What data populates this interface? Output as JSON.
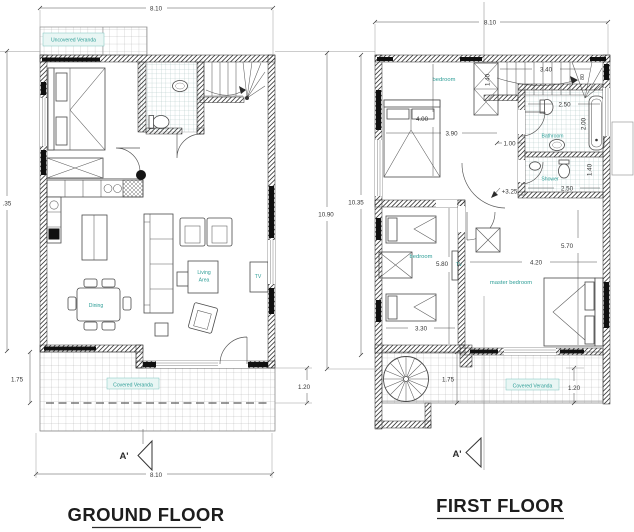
{
  "meta": {
    "teal": "#2e9e97",
    "line_color": "#2f2f2f"
  },
  "ground_floor": {
    "title": "GROUND FLOOR",
    "section_marker": "A'",
    "dims": {
      "top": "8.10",
      "bottom": "8.10",
      "left": ".35",
      "veranda_left": "1.75",
      "veranda_right": "1.20"
    },
    "labels": {
      "uncovered_veranda": "Uncovered Veranda",
      "covered_veranda": "Covered Veranda",
      "dining": "Dining",
      "living_line1": "Living",
      "living_line2": "Area",
      "tv": "TV"
    }
  },
  "first_floor": {
    "title": "FIRST FLOOR",
    "section_marker": "A'",
    "dims": {
      "top": "8.10",
      "outer_left": "10.90",
      "inner_left": "10.35",
      "bedroom1_height": "4.00",
      "bedroom1_width": "3.90",
      "stairs_run": "3.40",
      "stairs_side": "1.40",
      "stairs_width": "80",
      "hall": "1.00",
      "bathroom_width": "2.50",
      "bathtub": "2.00",
      "shower_width": "2.50",
      "shower_height": "1.40",
      "bedroom2_height": "5.80",
      "bedroom2_width": "3.30",
      "master_width": "4.20",
      "master_height": "5.70",
      "veranda_left": "1.75",
      "veranda_right": "1.20",
      "level": "+3.25"
    },
    "labels": {
      "bedroom1": "bedroom",
      "bedroom2": "bedroom",
      "master_bedroom": "master bedroom",
      "bathroom": "Bathroom",
      "shower": "Shower",
      "tv": "TV",
      "covered_veranda": "Covered Veranda"
    }
  }
}
